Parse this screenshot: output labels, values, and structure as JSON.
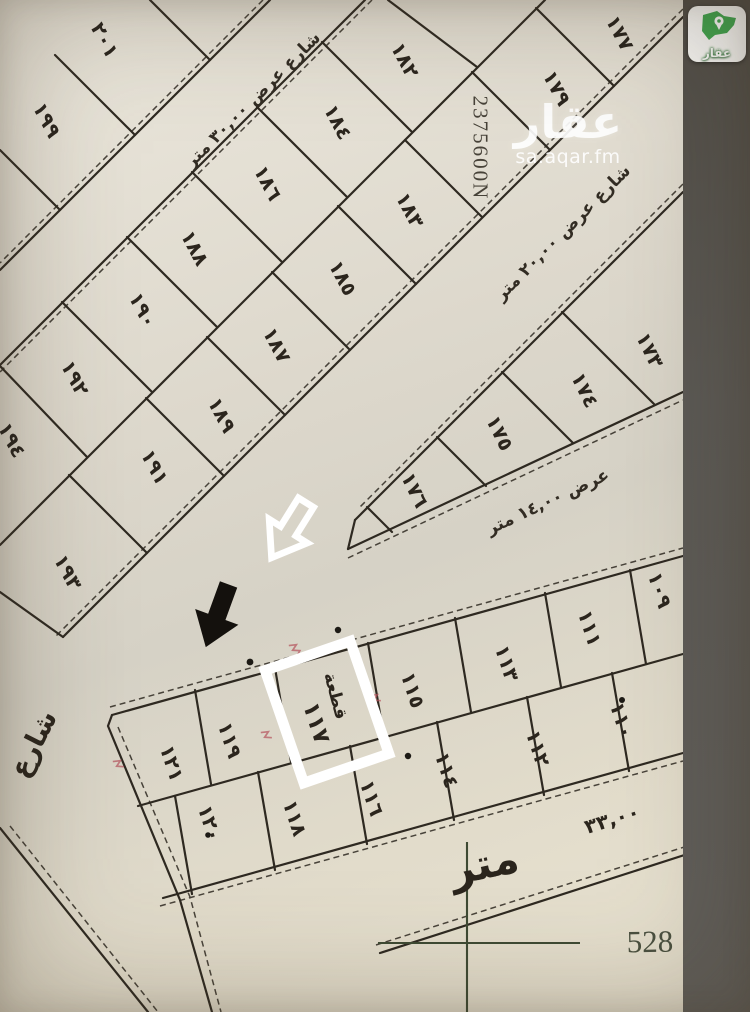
{
  "app": {
    "logo": {
      "label": "عقار",
      "brand_green": "#3fa74e"
    },
    "watermark": {
      "main": "عقار",
      "sub": "sa.aqar.fm"
    }
  },
  "map": {
    "highlight": {
      "annotation_word": "قطعة",
      "plot_number": "١١٧"
    },
    "survey": {
      "northing_label": "2375600N",
      "easting_label": "528",
      "street_name": "شارع",
      "meter_word": "متر",
      "edge_dimension": "٣٣,٠٠"
    },
    "street_labels": [
      {
        "text": "شارع عرض ٣٠,٠٠ متر",
        "x": 253,
        "y": 100,
        "r": -45,
        "size": 17
      },
      {
        "text": "شارع عرض ٢٠,٠٠ متر",
        "x": 563,
        "y": 233,
        "r": -45,
        "size": 17
      },
      {
        "text": "عرض ١٤,٠٠ متر",
        "x": 548,
        "y": 502,
        "r": -25,
        "size": 17
      }
    ],
    "plots": [
      {
        "n": "٢٠١",
        "x": 105,
        "y": 40,
        "r": 62
      },
      {
        "n": "١٩٩",
        "x": 47,
        "y": 120,
        "r": 62
      },
      {
        "n": "١٨٢",
        "x": 405,
        "y": 60,
        "r": 62
      },
      {
        "n": "١٨٤",
        "x": 338,
        "y": 122,
        "r": 62
      },
      {
        "n": "١٨٦",
        "x": 268,
        "y": 183,
        "r": 62
      },
      {
        "n": "١٨٨",
        "x": 195,
        "y": 248,
        "r": 62
      },
      {
        "n": "١٩٠",
        "x": 143,
        "y": 310,
        "r": 62
      },
      {
        "n": "١٩٢",
        "x": 75,
        "y": 378,
        "r": 62
      },
      {
        "n": "١٩٤",
        "x": 12,
        "y": 440,
        "r": 62
      },
      {
        "n": "١٧٧",
        "x": 620,
        "y": 33,
        "r": 62
      },
      {
        "n": "١٧٩",
        "x": 557,
        "y": 88,
        "r": 62
      },
      {
        "n": "١٨٣",
        "x": 410,
        "y": 210,
        "r": 62
      },
      {
        "n": "١٨٥",
        "x": 343,
        "y": 278,
        "r": 62
      },
      {
        "n": "١٨٧",
        "x": 277,
        "y": 345,
        "r": 62
      },
      {
        "n": "١٨٩",
        "x": 222,
        "y": 415,
        "r": 62
      },
      {
        "n": "١٩١",
        "x": 155,
        "y": 467,
        "r": 62
      },
      {
        "n": "١٩٣",
        "x": 68,
        "y": 572,
        "r": 62
      },
      {
        "n": "١٧٣",
        "x": 650,
        "y": 350,
        "r": 64
      },
      {
        "n": "١٧٤",
        "x": 585,
        "y": 390,
        "r": 64
      },
      {
        "n": "١٧٥",
        "x": 500,
        "y": 433,
        "r": 64
      },
      {
        "n": "١٧٦",
        "x": 415,
        "y": 490,
        "r": 64
      },
      {
        "n": "١٠٩",
        "x": 660,
        "y": 590,
        "r": 72
      },
      {
        "n": "١١١",
        "x": 590,
        "y": 628,
        "r": 72
      },
      {
        "n": "١١٣",
        "x": 507,
        "y": 663,
        "r": 72
      },
      {
        "n": "١١٥",
        "x": 413,
        "y": 690,
        "r": 72
      },
      {
        "n": "١١٩",
        "x": 230,
        "y": 740,
        "r": 72
      },
      {
        "n": "١٢١",
        "x": 172,
        "y": 763,
        "r": 72
      },
      {
        "n": "١١٠",
        "x": 622,
        "y": 720,
        "r": 72
      },
      {
        "n": "١١٢",
        "x": 538,
        "y": 748,
        "r": 72
      },
      {
        "n": "١١٤",
        "x": 447,
        "y": 770,
        "r": 72
      },
      {
        "n": "١١٦",
        "x": 372,
        "y": 798,
        "r": 72
      },
      {
        "n": "١١٨",
        "x": 295,
        "y": 818,
        "r": 72
      },
      {
        "n": "١٢٠",
        "x": 210,
        "y": 823,
        "r": 72
      }
    ]
  },
  "colors": {
    "paper": "#ddd8cb",
    "ink": "#2e2921",
    "grid_green": "#3e4a33",
    "photo_edge": "#57544f",
    "red_mark": "#b5525c",
    "highlight_box": "#ffffff"
  }
}
